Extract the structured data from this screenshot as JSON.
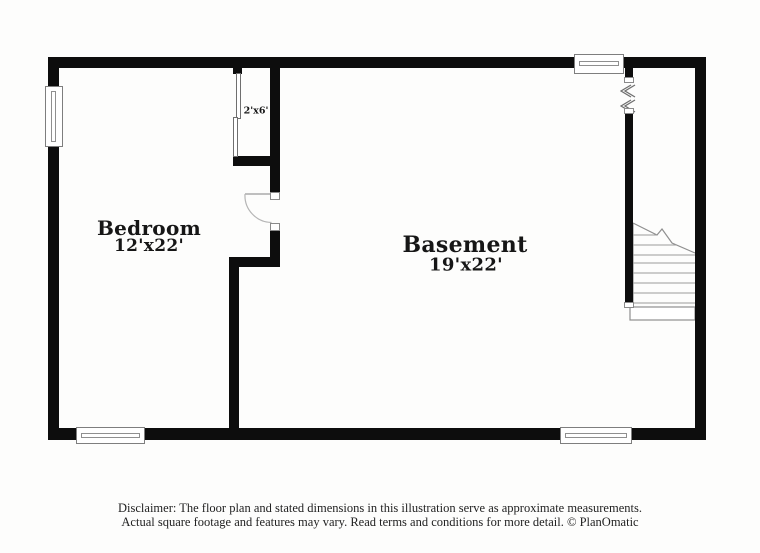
{
  "plan": {
    "type": "floor-plan",
    "rooms": {
      "bedroom": {
        "label": "Bedroom",
        "dims": "12'x22'"
      },
      "basement": {
        "label": "Basement",
        "dims": "19'x22'"
      },
      "closet": {
        "dims": "2'x6'"
      }
    },
    "symbols": [
      "window-icon",
      "door-swing-icon",
      "sliding-door-icon",
      "staircase-icon",
      "wall-break-icon"
    ]
  },
  "footer": {
    "line1": "Disclaimer: The floor plan and stated dimensions in this illustration serve as approximate measurements.",
    "line2": "Actual square footage and features may vary. Read terms and conditions for more detail. © PlanOmatic"
  },
  "colors": {
    "wall": "#0d0d0d",
    "fixture_outline": "#8a8a8a",
    "text": "#161616",
    "background": "#fdfdfc"
  }
}
